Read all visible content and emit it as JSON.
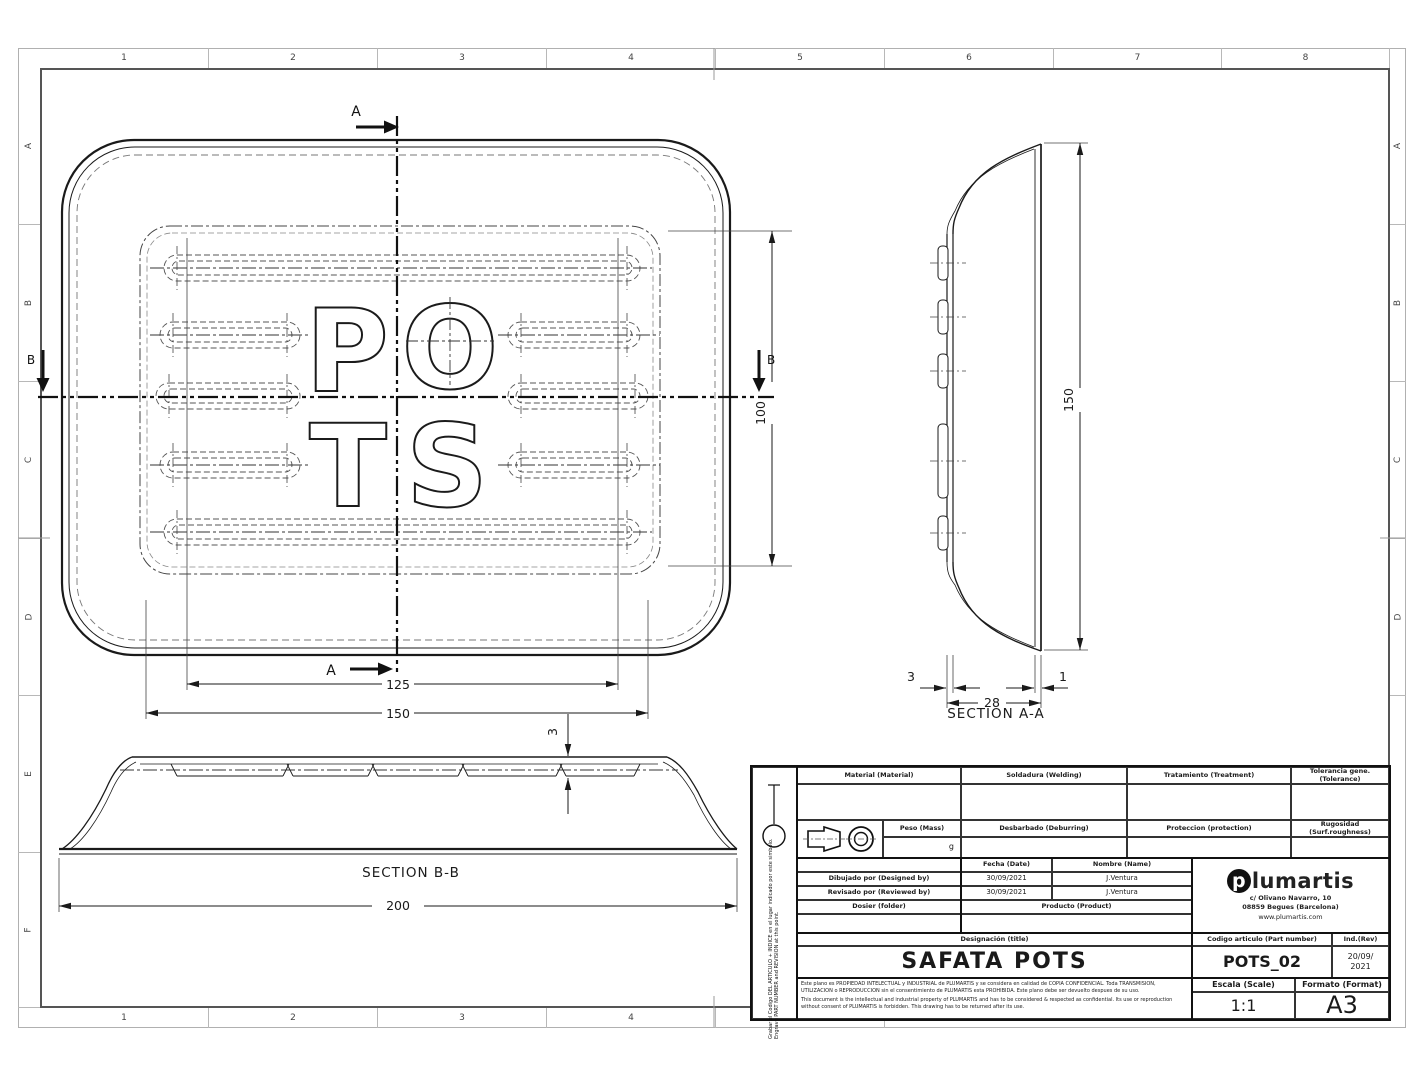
{
  "colors": {
    "line": "#1a1a1a",
    "frame_gray": "#b0b0b0",
    "brand_black": "#111111"
  },
  "sheet": {
    "zones": {
      "cols": [
        "1",
        "2",
        "3",
        "4",
        "5",
        "6",
        "7",
        "8"
      ],
      "rows_left": [
        "A",
        "B",
        "C",
        "D",
        "E",
        "F"
      ],
      "rows_right": [
        "A",
        "B",
        "C",
        "D"
      ]
    }
  },
  "views": {
    "top": {
      "emboss": [
        "P",
        "O",
        "T",
        "S"
      ],
      "cut_a": "A",
      "cut_b": "B",
      "dim_pattern_width": "125",
      "dim_flat_width": "150",
      "dim_pattern_height": "100"
    },
    "aa": {
      "title": "SECTION A-A",
      "dim_height": "150",
      "dim_wall": "3",
      "dim_depth": "28",
      "dim_lip": "1"
    },
    "bb": {
      "title": "SECTION B-B",
      "dim_length": "200",
      "dim_rib": "3"
    }
  },
  "titleblock": {
    "material_label": "Material (Material)",
    "welding_label": "Soldadura (Welding)",
    "treatment_label": "Tratamiento (Treatment)",
    "tolerance_label": "Tolerancia gene. (Tolerance)",
    "mass_label": "Peso (Mass)",
    "mass_unit": "g",
    "deburring_label": "Desbarbado (Deburring)",
    "protection_label": "Proteccion (protection)",
    "roughness_label": "Rugosidad (Surf.roughness)",
    "date_label": "Fecha (Date)",
    "name_label": "Nombre (Name)",
    "designed_label": "Dibujado por (Designed by)",
    "designed_date": "30/09/2021",
    "designed_name": "J.Ventura",
    "reviewed_label": "Revisado por (Reviewed by)",
    "reviewed_date": "30/09/2021",
    "reviewed_name": "J.Ventura",
    "folder_label": "Dosier (folder)",
    "product_label": "Producto (Product)",
    "designation_label": "Designación (title)",
    "designation_value": "SAFATA POTS",
    "partnumber_label": "Codigo articulo (Part number)",
    "partnumber_value": "POTS_02",
    "rev_label": "Ind.(Rev)",
    "rev_value_lines": [
      "20/09/",
      "2021"
    ],
    "scale_label": "Escala (Scale)",
    "scale_value": "1:1",
    "format_label": "Formato (Format)",
    "format_value": "A3",
    "company": {
      "logo_letter": "p",
      "logo_rest": "lumartis",
      "address1": "c/ Olivano Navarro, 10",
      "address2": "08859 Begues (Barcelona)",
      "web": "www.plumartis.com"
    },
    "engrave_note": "Grabar el Codigo DEL ARTICULO + INDICE en el lugar indicado por este simbolo. Engrave PART NUMBER and REVISION at this point.",
    "legal_es": "Este plano es PROPIEDAD INTELECTUAL y INDUSTRIAL de PLUMARTIS y se considera en calidad de COPIA CONFIDENCIAL. Toda TRANSMISION, UTILIZACION o REPRODUCCION sin el consentimiento de PLUMARTIS esta PROHIBIDA. Este plano debe ser devuelto despues de su uso.",
    "legal_en": "This document is the intellectual and industrial property of PLUMARTIS and has to be considered & respected as confidential. Its use or reproduction without consent of PLUMARTIS is forbidden. This drawing has to be returned after its use."
  }
}
